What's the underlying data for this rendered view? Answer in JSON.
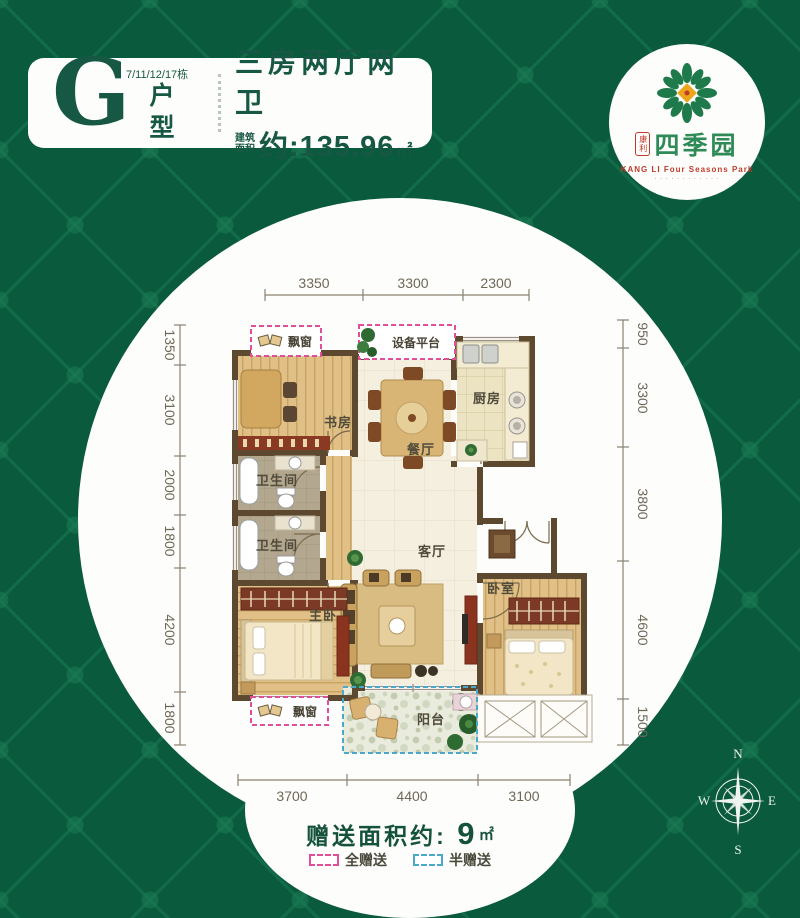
{
  "colors": {
    "background_green": "#0a5a3d",
    "title_green": "#175844",
    "dim_text": "#6f6858",
    "wall_brown": "#5c4930",
    "full_gift_pink": "#e0509a",
    "half_gift_blue": "#49a8cc",
    "logo_red": "#c03a2b",
    "logo_green": "#2e8b57"
  },
  "title_card": {
    "letter": "G",
    "buildings": "7/11/12/17栋",
    "type_label": "户型",
    "headline": "三房两厅两卫",
    "area_prefix_line1": "建筑",
    "area_prefix_line2": "面积",
    "area_value": "约:135.96",
    "area_unit": "㎡"
  },
  "logo": {
    "seal": "康利",
    "name": "四季园",
    "subtitle": "KANG LI Four Seasons Park",
    "tagline": "· · · · · · · · · · · ·"
  },
  "plan": {
    "labels": {
      "bay_window_top": "飘窗",
      "equipment_platform": "设备平台",
      "kitchen": "厨房",
      "study": "书房",
      "dining": "餐厅",
      "bath_upper": "卫生间",
      "bath_lower": "卫生间",
      "living": "客厅",
      "master_bedroom": "主卧",
      "bedroom": "卧室",
      "balcony": "阳台",
      "bay_window_bottom": "飘窗"
    },
    "dims": {
      "top": [
        "3350",
        "3300",
        "2300"
      ],
      "left": [
        "1350",
        "3100",
        "2000",
        "1800",
        "4200",
        "1800"
      ],
      "right": [
        "950",
        "3300",
        "3800",
        "4600",
        "1500"
      ],
      "bottom": [
        "3700",
        "4400",
        "3100"
      ]
    }
  },
  "footer": {
    "gift_label": "赠送面积约:",
    "gift_value": "9",
    "gift_unit": "㎡",
    "legend": [
      {
        "label": "全赠送"
      },
      {
        "label": "半赠送"
      }
    ]
  },
  "compass": {
    "n": "N",
    "e": "E",
    "s": "S",
    "w": "W"
  }
}
